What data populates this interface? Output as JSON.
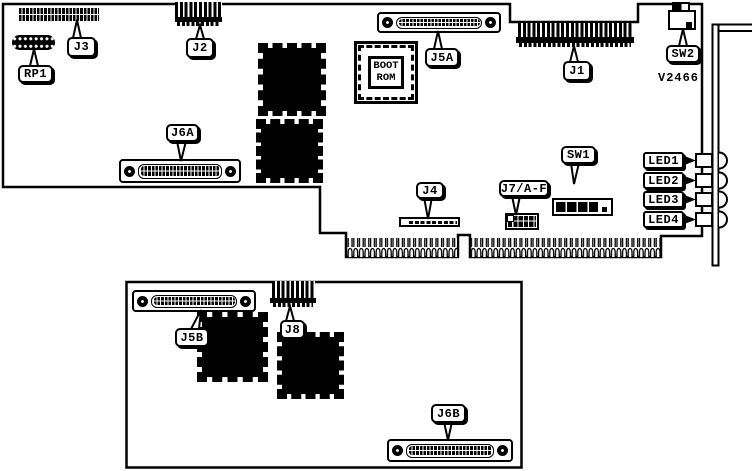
{
  "board_diagram": {
    "part_number": "V2466",
    "boot_rom": {
      "line1": "BOOT",
      "line2": "ROM"
    },
    "callouts": {
      "rp1": "RP1",
      "j3": "J3",
      "j2": "J2",
      "j5a": "J5A",
      "j1": "J1",
      "sw2": "SW2",
      "j6a": "J6A",
      "j4": "J4",
      "j7af": "J7/A-F",
      "sw1": "SW1",
      "led1": "LED1",
      "led2": "LED2",
      "led3": "LED3",
      "led4": "LED4",
      "j5b": "J5B",
      "j8": "J8",
      "j6b": "J6B"
    },
    "colors": {
      "ink": "#000000",
      "paper": "#ffffff"
    }
  }
}
